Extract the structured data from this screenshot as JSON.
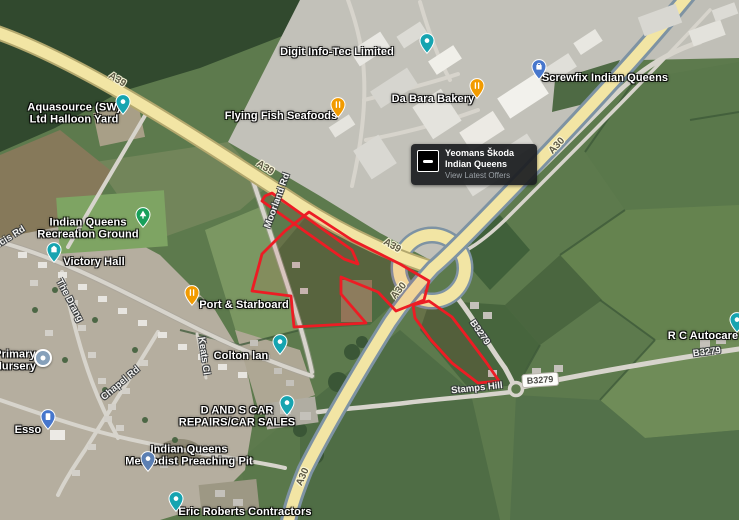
{
  "app": "satellite-map-view",
  "location": "Indian Queens A30 / A39 junction",
  "colors": {
    "parcel_outline": "#ed1c24",
    "a_road_fill": "#f2e5a4",
    "poi_teal": "#16a4b0",
    "poi_orange": "#f29b00",
    "poi_green": "#17a05a",
    "poi_blue": "#4676cc",
    "poi_slate": "#5b7fb3",
    "poi_school": "#86a0ba"
  },
  "roads": {
    "a39": "A39",
    "a30": "A30",
    "b3279": "B3279",
    "moorland_rd": "Moorland Rd",
    "francis_rd": "Francis Rd",
    "the_drang": "The Drang",
    "chapel_rd": "Chapel Rd",
    "keats_cl": "Keats Cl",
    "stamps_hill": "Stamps Hill"
  },
  "places": {
    "digit_info_tec": "Digit Info-Tec Limited",
    "screwfix": "Screwfix Indian Queens",
    "aquasource": {
      "line1": "Aquasource (SW)",
      "line2": "Ltd Halloon Yard"
    },
    "flying_fish": "Flying Fish Seafoods",
    "da_bara": "Da Bara Bakery",
    "recreation_ground": {
      "line1": "Indian Queens",
      "line2": "Recreation Ground"
    },
    "victory_hall": "Victory Hall",
    "primary_nursery": {
      "line1": "Primary",
      "line2": "Nursery"
    },
    "esso": "Esso",
    "port_starboard": "Port & Starboard",
    "colton_lan": "Colton lan",
    "d_and_s": {
      "line1": "D AND S CAR",
      "line2": "REPAIRS/CAR SALES"
    },
    "methodist": {
      "line1": "Indian Queens",
      "line2": "Methodist Preaching Pit"
    },
    "eric_roberts": "Eric Roberts Contractors",
    "rc_autocare": "R C Autocare"
  },
  "pin_types": {
    "generic": "teal-teardrop-pin",
    "food": "orange-restaurant-pin",
    "park": "green-tree-pin",
    "shopping": "blue-shopping-pin",
    "fuel": "blue-fuel-pin",
    "school": "slate-circle-pin",
    "worship": "slate-teardrop-pin"
  },
  "ad_card": {
    "title_line1": "Yeomans Škoda",
    "title_line2": "Indian Queens",
    "cta": "View Latest Offers"
  }
}
